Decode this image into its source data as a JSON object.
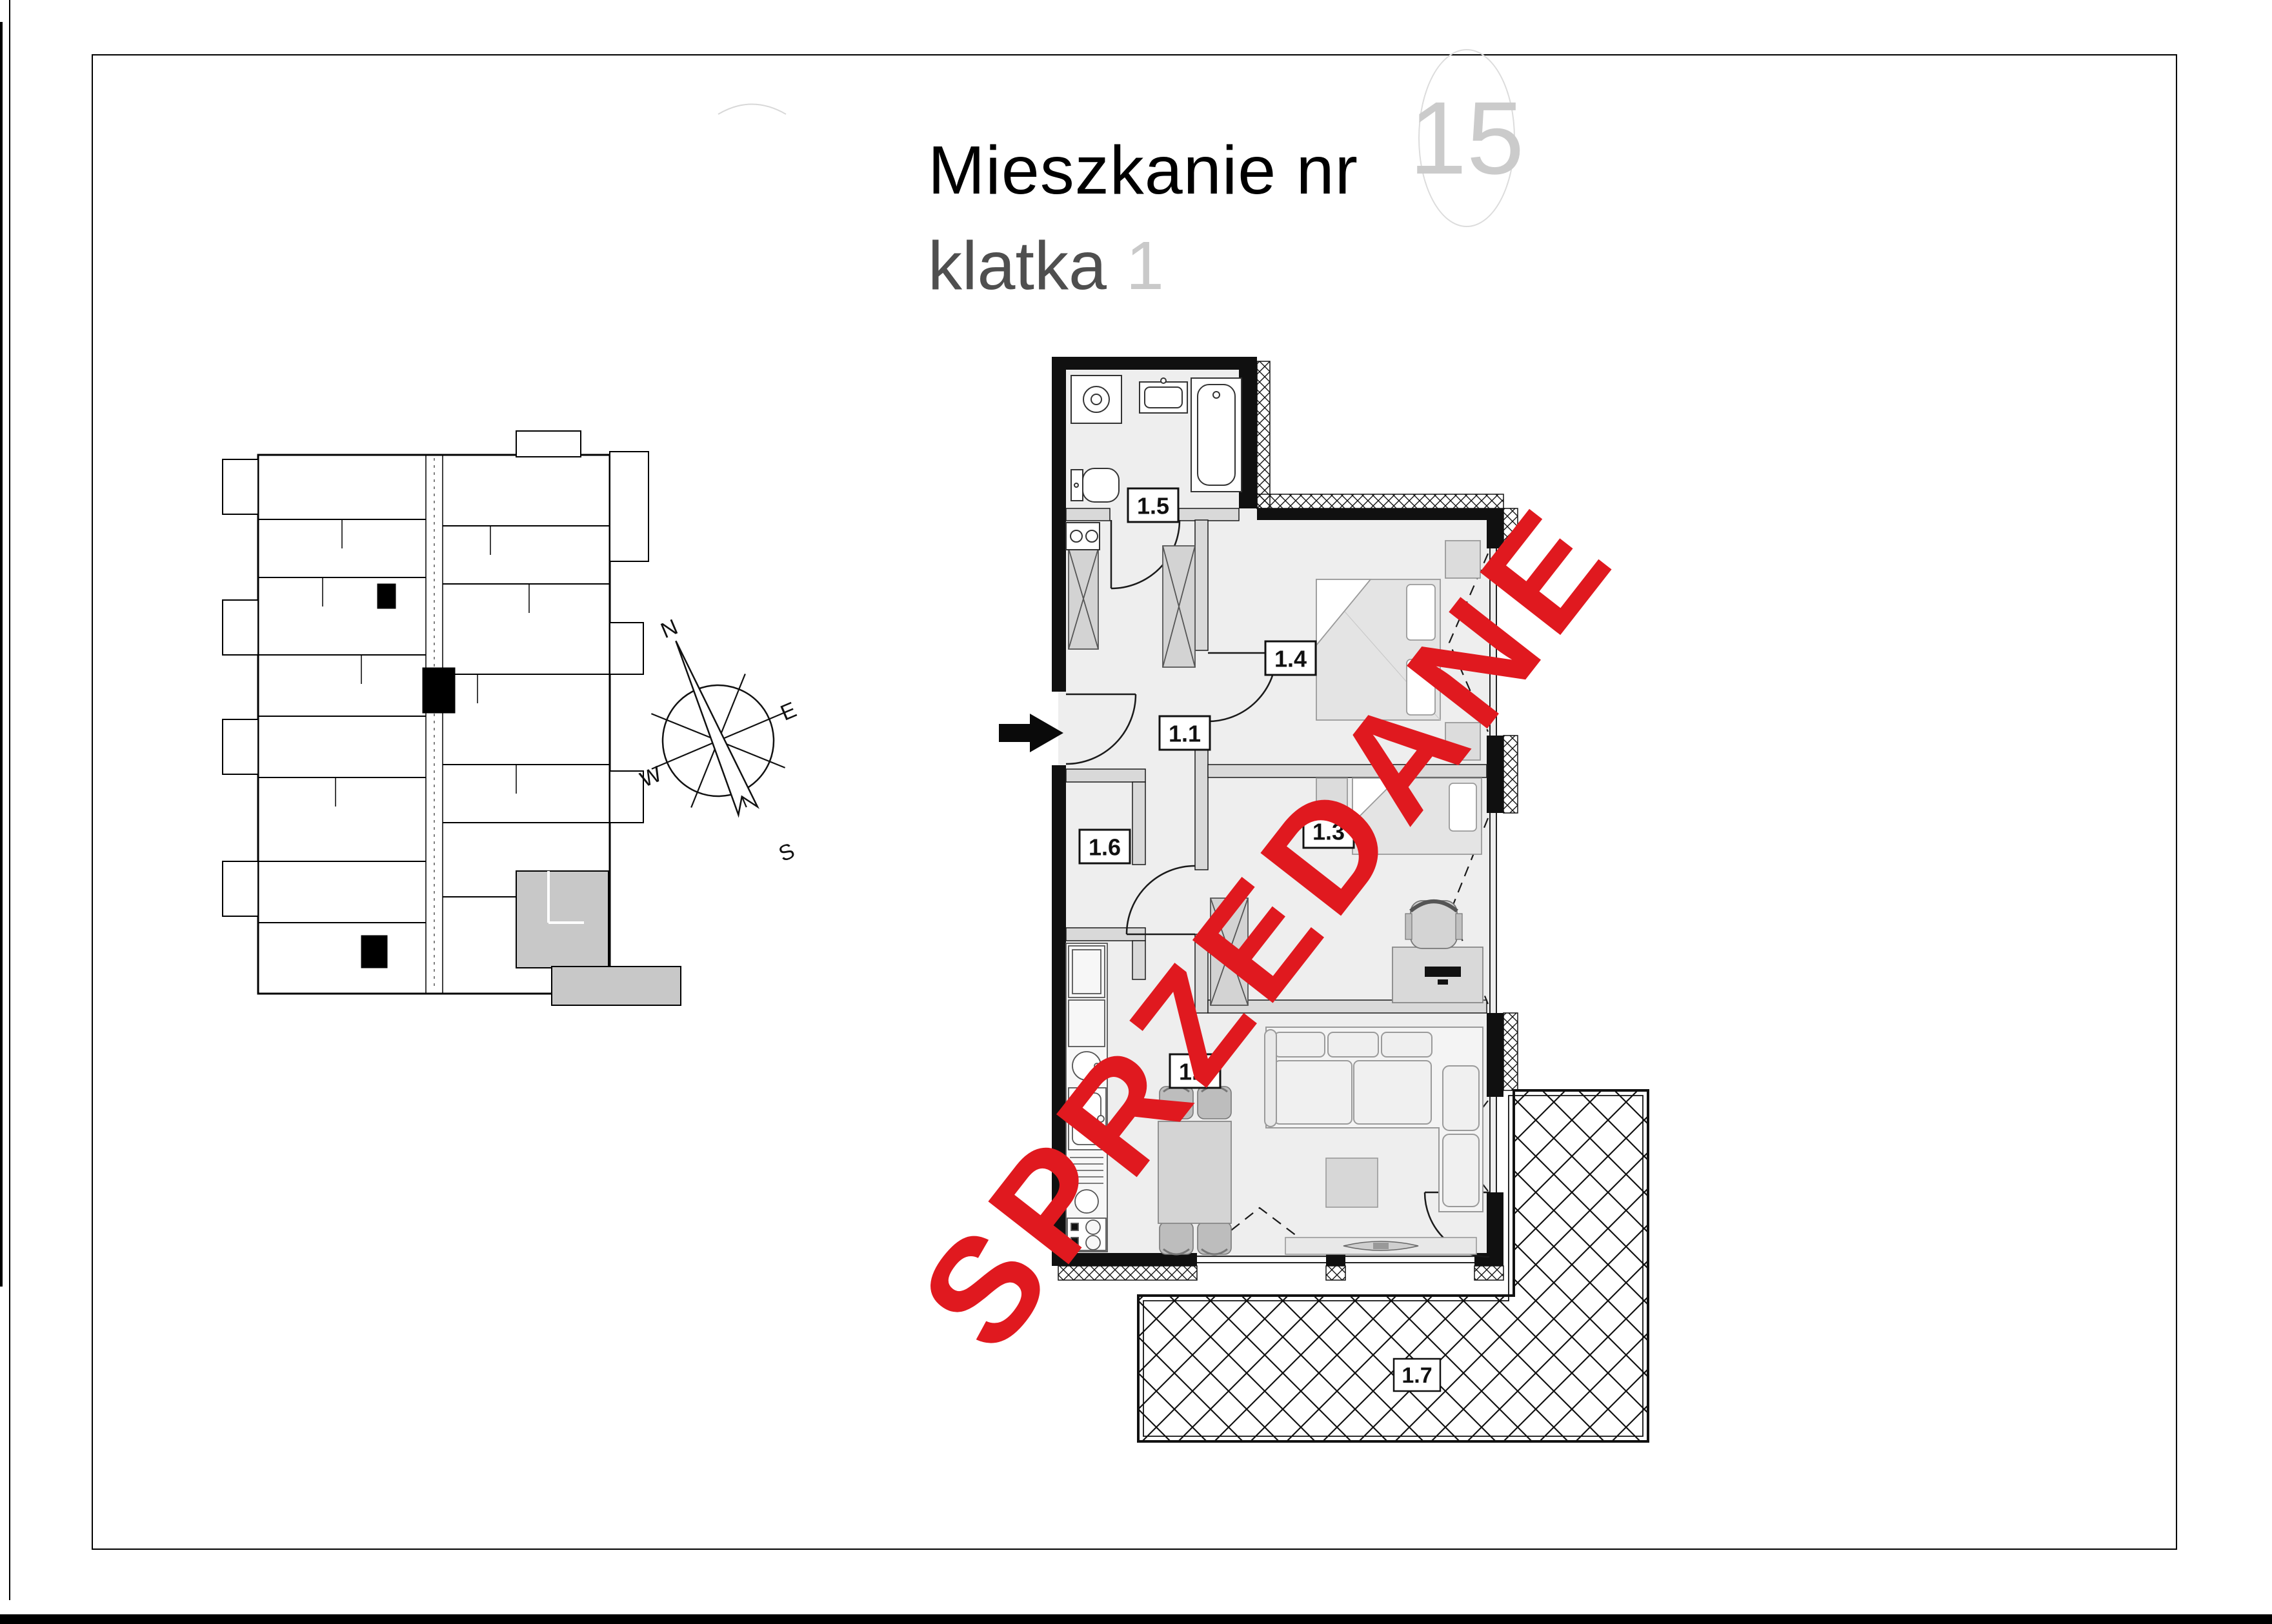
{
  "header": {
    "title": "Mieszkanie nr",
    "unit_number": "15",
    "subtitle": "klatka",
    "staircase_number": "1"
  },
  "watermark": {
    "text": "SPRZEDANE"
  },
  "compass": {
    "north": "N",
    "east": "E",
    "south": "S",
    "west": "W"
  },
  "floor_plan": {
    "rooms": {
      "r1_1": "1.1",
      "r1_2": "1.2",
      "r1_3": "1.3",
      "r1_4": "1.4",
      "r1_5": "1.5",
      "r1_6": "1.6",
      "r1_7": "1.7"
    }
  },
  "colors": {
    "watermark_red": "#e0191f",
    "badge_gray": "#cbcbcb",
    "subtitle_gray": "#4f4f4f"
  }
}
